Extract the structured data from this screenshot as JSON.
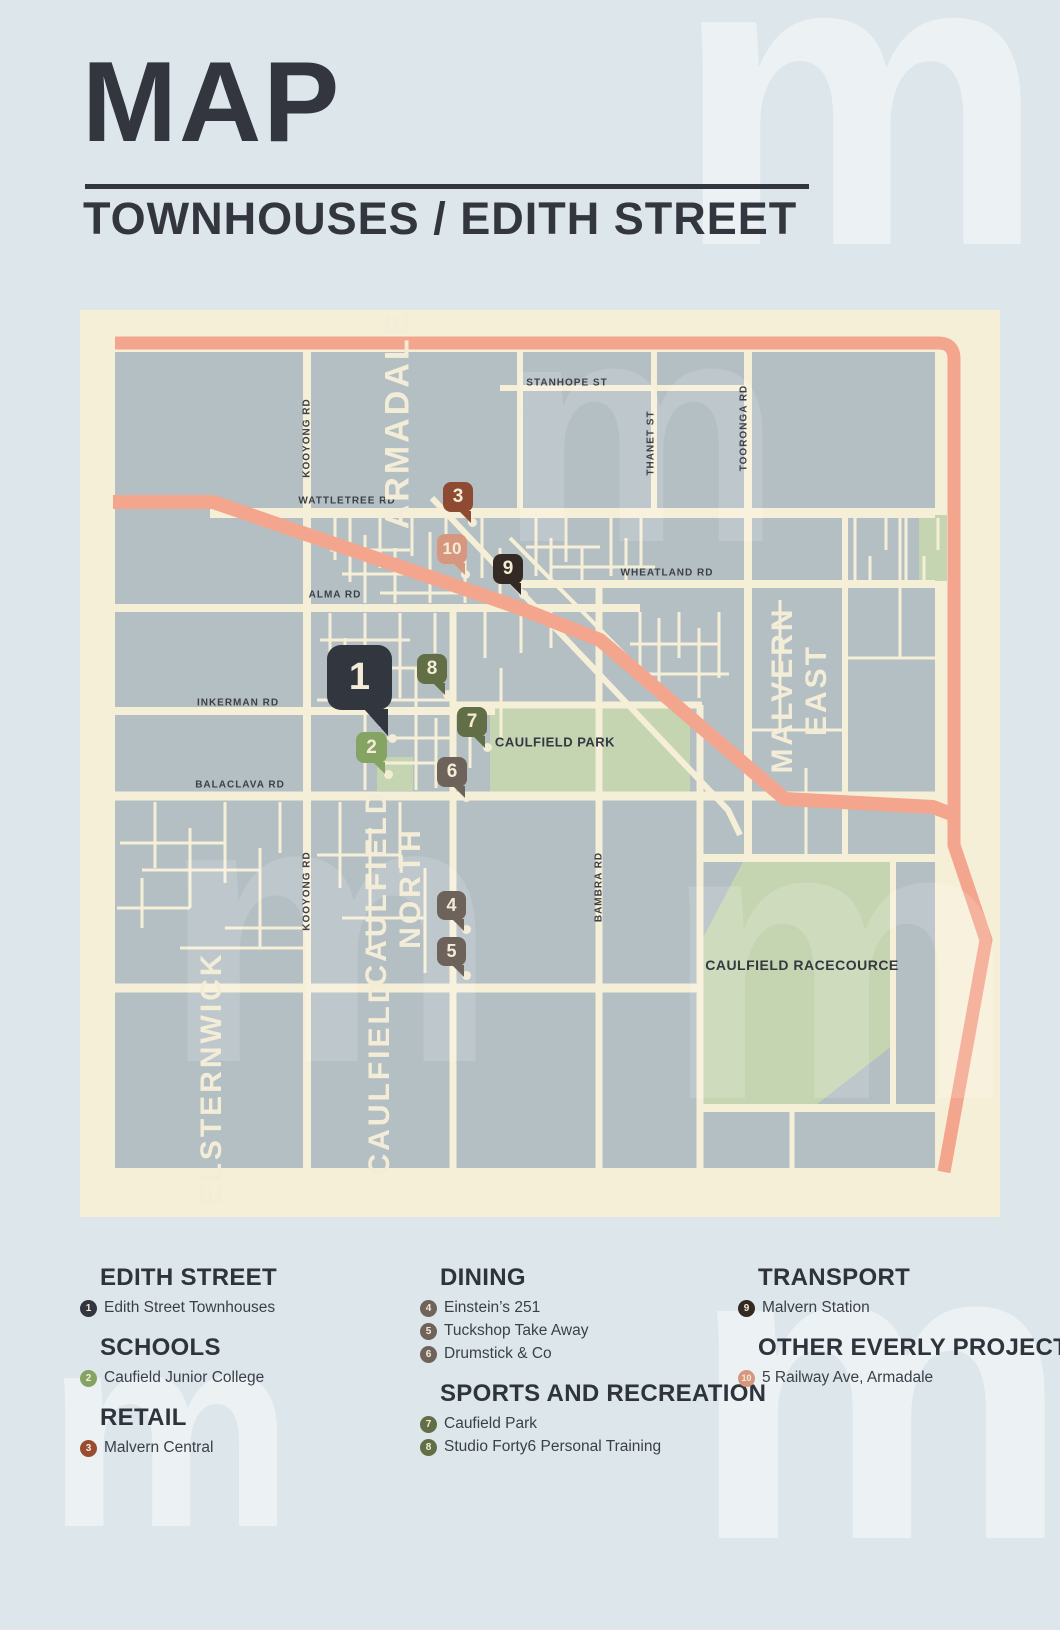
{
  "title": "MAP",
  "subtitle": "TOWNHOUSES / EDITH STREET",
  "watermark_glyph": "m",
  "colors": {
    "poster_bg": "#dde6eb",
    "map_bg": "#f6efd8",
    "block": "#b4bfc4",
    "park": "#c6d5b1",
    "highway": "#f4a58d",
    "ink": "#33363f",
    "cream_text": "#f3edd8"
  },
  "map": {
    "street_labels": [
      {
        "text": "STANHOPE ST",
        "x": 487,
        "y": 73,
        "rot": 0
      },
      {
        "text": "THANET ST",
        "x": 571,
        "y": 133,
        "rot": -90
      },
      {
        "text": "TOORONGA RD",
        "x": 664,
        "y": 118,
        "rot": -90
      },
      {
        "text": "WATTLETREE RD",
        "x": 267,
        "y": 191,
        "rot": 0
      },
      {
        "text": "WHEATLAND RD",
        "x": 587,
        "y": 263,
        "rot": 0
      },
      {
        "text": "ALMA RD",
        "x": 255,
        "y": 285,
        "rot": 0
      },
      {
        "text": "INKERMAN RD",
        "x": 158,
        "y": 393,
        "rot": 0
      },
      {
        "text": "BALACLAVA RD",
        "x": 160,
        "y": 475,
        "rot": 0
      },
      {
        "text": "KOOYONG RD",
        "x": 227,
        "y": 128,
        "rot": -90
      },
      {
        "text": "KOOYONG RD",
        "x": 227,
        "y": 581,
        "rot": -90
      },
      {
        "text": "BAMBRA RD",
        "x": 519,
        "y": 577,
        "rot": -90
      }
    ],
    "area_labels": [
      {
        "lines": [
          "ARMADALE"
        ],
        "x": 318,
        "y": 110,
        "size": 34
      },
      {
        "lines": [
          "MALVERN",
          "EAST"
        ],
        "x": 720,
        "y": 380,
        "size": 30
      },
      {
        "lines": [
          "CAULFIELD",
          "NORTH"
        ],
        "x": 314,
        "y": 578,
        "size": 30
      },
      {
        "lines": [
          "CAULFIELD"
        ],
        "x": 300,
        "y": 767,
        "size": 30
      },
      {
        "lines": [
          "ELSTERNWICK"
        ],
        "x": 132,
        "y": 768,
        "size": 30
      }
    ],
    "poi_labels": [
      {
        "text": "CAULFIELD PARK",
        "x": 475,
        "y": 432,
        "size": 13
      },
      {
        "text": "CAULFIELD RACECOURCE",
        "x": 722,
        "y": 655,
        "size": 14
      }
    ],
    "markers": [
      {
        "number": "1",
        "color": "#32363f",
        "x": 247,
        "y": 335,
        "size": 65,
        "font": 38,
        "dot_x": 312,
        "dot_y": 428
      },
      {
        "number": "2",
        "color": "#85a464",
        "x": 276,
        "y": 422,
        "size": 31,
        "font": 19,
        "dot_x": 308,
        "dot_y": 464
      },
      {
        "number": "3",
        "color": "#8f4a33",
        "x": 363,
        "y": 172,
        "size": 30,
        "font": 19,
        "dot_x": 392,
        "dot_y": 212
      },
      {
        "number": "4",
        "color": "#6e635a",
        "x": 357,
        "y": 581,
        "size": 29,
        "font": 18,
        "dot_x": 386,
        "dot_y": 619
      },
      {
        "number": "5",
        "color": "#6e635a",
        "x": 357,
        "y": 627,
        "size": 29,
        "font": 18,
        "dot_x": 386,
        "dot_y": 665
      },
      {
        "number": "6",
        "color": "#6e635a",
        "x": 357,
        "y": 447,
        "size": 30,
        "font": 19,
        "dot_x": 386,
        "dot_y": 487
      },
      {
        "number": "7",
        "color": "#626e46",
        "x": 377,
        "y": 397,
        "size": 30,
        "font": 19,
        "dot_x": 407,
        "dot_y": 437
      },
      {
        "number": "8",
        "color": "#626e46",
        "x": 337,
        "y": 344,
        "size": 30,
        "font": 19,
        "dot_x": 367,
        "dot_y": 384
      },
      {
        "number": "9",
        "color": "#342a24",
        "x": 413,
        "y": 244,
        "size": 30,
        "font": 19,
        "dot_x": 443,
        "dot_y": 284
      },
      {
        "number": "10",
        "color": "#d7977f",
        "x": 357,
        "y": 224,
        "size": 30,
        "font": 17,
        "dot_x": 385,
        "dot_y": 264
      }
    ]
  },
  "legend": {
    "columns": [
      {
        "x": 80,
        "sections": [
          {
            "heading": "EDITH STREET",
            "items": [
              {
                "number": "1",
                "color": "#32363f",
                "label": "Edith Street Townhouses"
              }
            ]
          },
          {
            "heading": "SCHOOLS",
            "items": [
              {
                "number": "2",
                "color": "#85a464",
                "label": "Caufield Junior College"
              }
            ]
          },
          {
            "heading": "RETAIL",
            "items": [
              {
                "number": "3",
                "color": "#9a4c31",
                "label": "Malvern Central"
              }
            ]
          }
        ]
      },
      {
        "x": 420,
        "sections": [
          {
            "heading": "DINING",
            "items": [
              {
                "number": "4",
                "color": "#6f635b",
                "label": "Einstein’s 251"
              },
              {
                "number": "5",
                "color": "#6f635b",
                "label": "Tuckshop Take Away"
              },
              {
                "number": "6",
                "color": "#6f635b",
                "label": "Drumstick & Co"
              }
            ]
          },
          {
            "heading": "SPORTS AND RECREATION",
            "items": [
              {
                "number": "7",
                "color": "#626e46",
                "label": "Caufield Park"
              },
              {
                "number": "8",
                "color": "#626e46",
                "label": "Studio Forty6 Personal Training"
              }
            ]
          }
        ]
      },
      {
        "x": 738,
        "sections": [
          {
            "heading": "TRANSPORT",
            "items": [
              {
                "number": "9",
                "color": "#342a24",
                "label": "Malvern Station"
              }
            ]
          },
          {
            "heading": "OTHER EVERLY PROJECTS",
            "items": [
              {
                "number": "10",
                "color": "#d7977f",
                "label": "5 Railway Ave, Armadale"
              }
            ]
          }
        ]
      }
    ]
  }
}
